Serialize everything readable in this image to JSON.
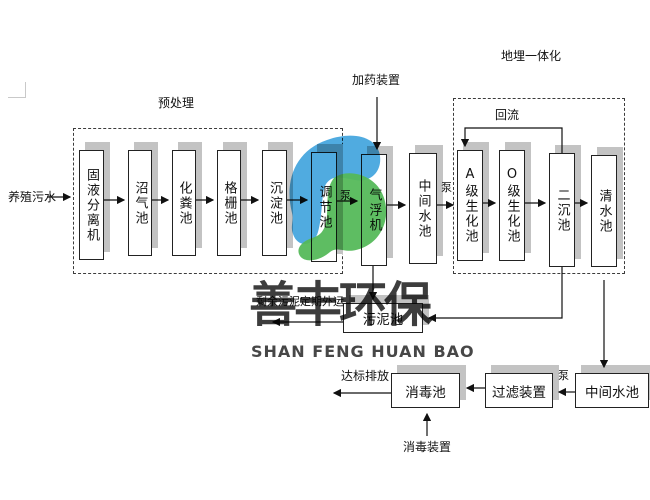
{
  "watermark": {
    "cn": "善丰环保",
    "en": "SHAN FENG HUAN BAO",
    "logo_blue": "#47a7de",
    "logo_green": "#55b95a"
  },
  "labels": {
    "influent": "养殖污水",
    "pretreatment": "预处理",
    "dosing_device": "加药装置",
    "buried_integration": "地埋一体化",
    "reflux": "回流",
    "sludge_out": "剩余污泥定期外运",
    "discharge": "达标排放",
    "disinfection_device": "消毒装置",
    "pump": "泵"
  },
  "vtanks": [
    {
      "label": "固液分离机"
    },
    {
      "label": "沼气池"
    },
    {
      "label": "化粪池"
    },
    {
      "label": "格栅池"
    },
    {
      "label": "沉淀池"
    },
    {
      "label": "调节池"
    },
    {
      "label": "气浮机"
    },
    {
      "label": "中间水池"
    },
    {
      "label": "A级生化池"
    },
    {
      "label": "O级生化池"
    },
    {
      "label": "二沉池"
    },
    {
      "label": "清水池"
    }
  ],
  "htanks": [
    {
      "label": "污泥池"
    },
    {
      "label": "消毒池"
    },
    {
      "label": "过滤装置"
    },
    {
      "label": "中间水池"
    }
  ]
}
